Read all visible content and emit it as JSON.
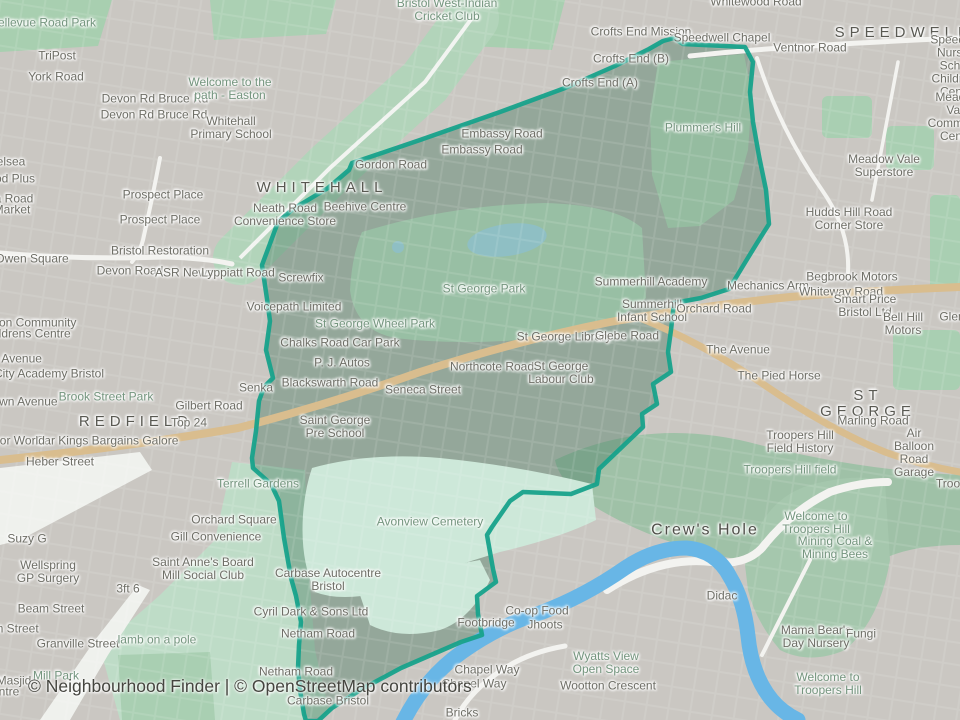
{
  "map": {
    "attribution": "© Neighbourhood Finder | © OpenStreetMap contributors",
    "colors": {
      "boundary": "#17a28b",
      "river": "#68b6e6",
      "primary_road": "#d9bd8e",
      "park_green": "#98bfa4",
      "cemetery_mint": "#cde8d9",
      "base_gray": "#cac7c2",
      "interior_tint": "#94a79a"
    },
    "district_labels": [
      "WHITEHALL",
      "REDFIELD",
      "SPEEDWELL",
      "ST GEORGE",
      "Crew's Hole"
    ],
    "labels": [
      {
        "t": "Bellevue Road Park",
        "x": 43,
        "y": 23,
        "k": "g"
      },
      {
        "t": "TriPost",
        "x": 57,
        "y": 56
      },
      {
        "t": "York Road",
        "x": 56,
        "y": 77
      },
      {
        "t": "Devon Rd Bruce Rd",
        "x": 155,
        "y": 99
      },
      {
        "t": "Devon Rd Bruce Rd",
        "x": 154,
        "y": 115
      },
      {
        "t": "Welcome to the\npath - Easton",
        "x": 230,
        "y": 89,
        "k": "g"
      },
      {
        "t": "Whitehall\nPrimary School",
        "x": 231,
        "y": 128
      },
      {
        "t": "Prospect Place",
        "x": 163,
        "y": 195
      },
      {
        "t": "Prospect Place",
        "x": 160,
        "y": 220
      },
      {
        "t": "elsea",
        "x": 11,
        "y": 162
      },
      {
        "t": "od Plus",
        "x": 15,
        "y": 179
      },
      {
        "t": "a Road",
        "x": 14,
        "y": 199
      },
      {
        "t": "Market",
        "x": 12,
        "y": 210
      },
      {
        "t": "Owen Square",
        "x": 32,
        "y": 259
      },
      {
        "t": "Bristol Restoration",
        "x": 160,
        "y": 251
      },
      {
        "t": "Devon Road",
        "x": 130,
        "y": 271
      },
      {
        "t": "ASR News",
        "x": 184,
        "y": 273
      },
      {
        "t": "Lyppiatt Road",
        "x": 238,
        "y": 273
      },
      {
        "t": "ston Community",
        "x": 33,
        "y": 323
      },
      {
        "t": "hildrens Centre",
        "x": 30,
        "y": 334
      },
      {
        "t": "u Avenue",
        "x": 17,
        "y": 359
      },
      {
        "t": "City Academy Bristol",
        "x": 49,
        "y": 374
      },
      {
        "t": "Brook Street Park",
        "x": 106,
        "y": 397,
        "k": "g"
      },
      {
        "t": "own Avenue",
        "x": 25,
        "y": 402
      },
      {
        "t": "Gilbert Road",
        "x": 209,
        "y": 406
      },
      {
        "t": "REDFIELD",
        "x": 136,
        "y": 422,
        "k": "a"
      },
      {
        "t": "Top 24",
        "x": 189,
        "y": 423
      },
      {
        "t": "Car Kings Bargains Galore",
        "x": 107,
        "y": 441
      },
      {
        "t": "oor World",
        "x": 19,
        "y": 441
      },
      {
        "t": "Heber Street",
        "x": 60,
        "y": 462
      },
      {
        "t": "Bristol West-Indian\nCricket Club",
        "x": 447,
        "y": 10,
        "k": "g"
      },
      {
        "t": "Whitewood Road",
        "x": 756,
        "y": 2
      },
      {
        "t": "Crofts End Mission",
        "x": 641,
        "y": 32
      },
      {
        "t": "Speedwell Chapel",
        "x": 722,
        "y": 38
      },
      {
        "t": "SPEEDWELL",
        "x": 903,
        "y": 33,
        "k": "a"
      },
      {
        "t": "Ventnor Road",
        "x": 810,
        "y": 48
      },
      {
        "t": "Crofts End (B)",
        "x": 631,
        "y": 59
      },
      {
        "t": "Crofts End (A)",
        "x": 600,
        "y": 83
      },
      {
        "t": "Speedwell\nNursery School\nChildren's Centre",
        "x": 958,
        "y": 66
      },
      {
        "t": "Meadow Vale\nCommunity Centre",
        "x": 958,
        "y": 117
      },
      {
        "t": "Plummer's Hill",
        "x": 703,
        "y": 128,
        "k": "g"
      },
      {
        "t": "Meadow Vale\nSuperstore",
        "x": 884,
        "y": 166
      },
      {
        "t": "Hudds Hill Road\nCorner Store",
        "x": 849,
        "y": 219
      },
      {
        "t": "Embassy Road",
        "x": 502,
        "y": 134
      },
      {
        "t": "Embassy Road",
        "x": 482,
        "y": 150
      },
      {
        "t": "Gordon Road",
        "x": 391,
        "y": 165
      },
      {
        "t": "WHITEHALL",
        "x": 322,
        "y": 188,
        "k": "a"
      },
      {
        "t": "Neath Road\nConvenience Store",
        "x": 285,
        "y": 215
      },
      {
        "t": "Beehive Centre",
        "x": 365,
        "y": 207
      },
      {
        "t": "Screwfix",
        "x": 301,
        "y": 278
      },
      {
        "t": "Voicepath Limited",
        "x": 294,
        "y": 307
      },
      {
        "t": "St George Park",
        "x": 484,
        "y": 289,
        "k": "g"
      },
      {
        "t": "Summerhill Academy",
        "x": 651,
        "y": 282
      },
      {
        "t": "Summerhill\nInfant School",
        "x": 652,
        "y": 311
      },
      {
        "t": "Mechanics Arm",
        "x": 768,
        "y": 286
      },
      {
        "t": "Orchard Road",
        "x": 714,
        "y": 309
      },
      {
        "t": "Begbrook Motors",
        "x": 852,
        "y": 277
      },
      {
        "t": "Whiteway Road",
        "x": 841,
        "y": 292
      },
      {
        "t": "Smart Price Bristol Ltd",
        "x": 865,
        "y": 306
      },
      {
        "t": "Bell Hill Motors",
        "x": 903,
        "y": 324
      },
      {
        "t": "Glen",
        "x": 952,
        "y": 317
      },
      {
        "t": "St George Wheel Park",
        "x": 375,
        "y": 324,
        "k": "g"
      },
      {
        "t": "Chalks Road Car Park",
        "x": 340,
        "y": 343
      },
      {
        "t": "P. J. Autos",
        "x": 342,
        "y": 363
      },
      {
        "t": "St George Library",
        "x": 564,
        "y": 337
      },
      {
        "t": "Glebe Road",
        "x": 627,
        "y": 336
      },
      {
        "t": "Northcote Road",
        "x": 492,
        "y": 367
      },
      {
        "t": "St George\nLabour Club",
        "x": 561,
        "y": 373
      },
      {
        "t": "Blackswarth Road",
        "x": 330,
        "y": 383
      },
      {
        "t": "Senka",
        "x": 256,
        "y": 388
      },
      {
        "t": "Seneca Street",
        "x": 423,
        "y": 390
      },
      {
        "t": "The Avenue",
        "x": 738,
        "y": 350
      },
      {
        "t": "The Pied Horse",
        "x": 779,
        "y": 376
      },
      {
        "t": "ST GEORGE",
        "x": 868,
        "y": 404,
        "k": "a"
      },
      {
        "t": "Marling Road",
        "x": 873,
        "y": 421
      },
      {
        "t": "Saint George\nPre School",
        "x": 335,
        "y": 427
      },
      {
        "t": "Troopers Hill\nField History",
        "x": 800,
        "y": 442
      },
      {
        "t": "Air Balloon\nRoad Garage",
        "x": 914,
        "y": 453
      },
      {
        "t": "Troopers Hill field",
        "x": 790,
        "y": 470,
        "k": "g"
      },
      {
        "t": "Troo",
        "x": 948,
        "y": 484
      },
      {
        "t": "Terrell Gardens",
        "x": 258,
        "y": 484,
        "k": "g"
      },
      {
        "t": "Orchard Square",
        "x": 234,
        "y": 520
      },
      {
        "t": "Gill Convenience",
        "x": 216,
        "y": 537
      },
      {
        "t": "Avonview Cemetery",
        "x": 430,
        "y": 522,
        "k": "g"
      },
      {
        "t": "Crew's Hole",
        "x": 705,
        "y": 530,
        "k": "a2"
      },
      {
        "t": "Welcome to\nTroopers Hill",
        "x": 816,
        "y": 523,
        "k": "g"
      },
      {
        "t": "Mining Coal &\nMining Bees",
        "x": 835,
        "y": 548,
        "k": "g"
      },
      {
        "t": "Suzy G",
        "x": 27,
        "y": 539
      },
      {
        "t": "Saint Anne's Board\nMill Social Club",
        "x": 203,
        "y": 569
      },
      {
        "t": "Wellspring\nGP Surgery",
        "x": 48,
        "y": 572
      },
      {
        "t": "3ft 6",
        "x": 128,
        "y": 589
      },
      {
        "t": "Beam Street",
        "x": 51,
        "y": 609
      },
      {
        "t": "m Street",
        "x": 16,
        "y": 629
      },
      {
        "t": "Granville Street",
        "x": 78,
        "y": 644
      },
      {
        "t": "lamb on a pole",
        "x": 157,
        "y": 640,
        "k": "g"
      },
      {
        "t": "Mill Park",
        "x": 56,
        "y": 676,
        "k": "g"
      },
      {
        "t": "Masjid",
        "x": 14,
        "y": 681
      },
      {
        "t": "ntre",
        "x": 9,
        "y": 692
      },
      {
        "t": "Carbase Autocentre\nBristol",
        "x": 328,
        "y": 580
      },
      {
        "t": "Cyril Dark & Sons Ltd",
        "x": 311,
        "y": 612
      },
      {
        "t": "Netham Road",
        "x": 318,
        "y": 634
      },
      {
        "t": "Netham Road",
        "x": 296,
        "y": 672
      },
      {
        "t": "Carbase Bristol",
        "x": 328,
        "y": 701
      },
      {
        "t": "Didac",
        "x": 722,
        "y": 596
      },
      {
        "t": "Co-op Food",
        "x": 537,
        "y": 611
      },
      {
        "t": "Jhoots",
        "x": 545,
        "y": 625
      },
      {
        "t": "Footbridge",
        "x": 486,
        "y": 623
      },
      {
        "t": "Chapel Way",
        "x": 487,
        "y": 670
      },
      {
        "t": "Chapel Way",
        "x": 474,
        "y": 684
      },
      {
        "t": "Wyatts View\nOpen Space",
        "x": 606,
        "y": 663,
        "k": "g"
      },
      {
        "t": "Wootton Crescent",
        "x": 608,
        "y": 686
      },
      {
        "t": "Bricks",
        "x": 462,
        "y": 713
      },
      {
        "t": "Mama Bear's\nDay Nursery",
        "x": 816,
        "y": 637
      },
      {
        "t": "Fungi",
        "x": 861,
        "y": 634
      },
      {
        "t": "Welcome to\nTroopers Hill",
        "x": 828,
        "y": 684,
        "k": "g"
      }
    ]
  }
}
